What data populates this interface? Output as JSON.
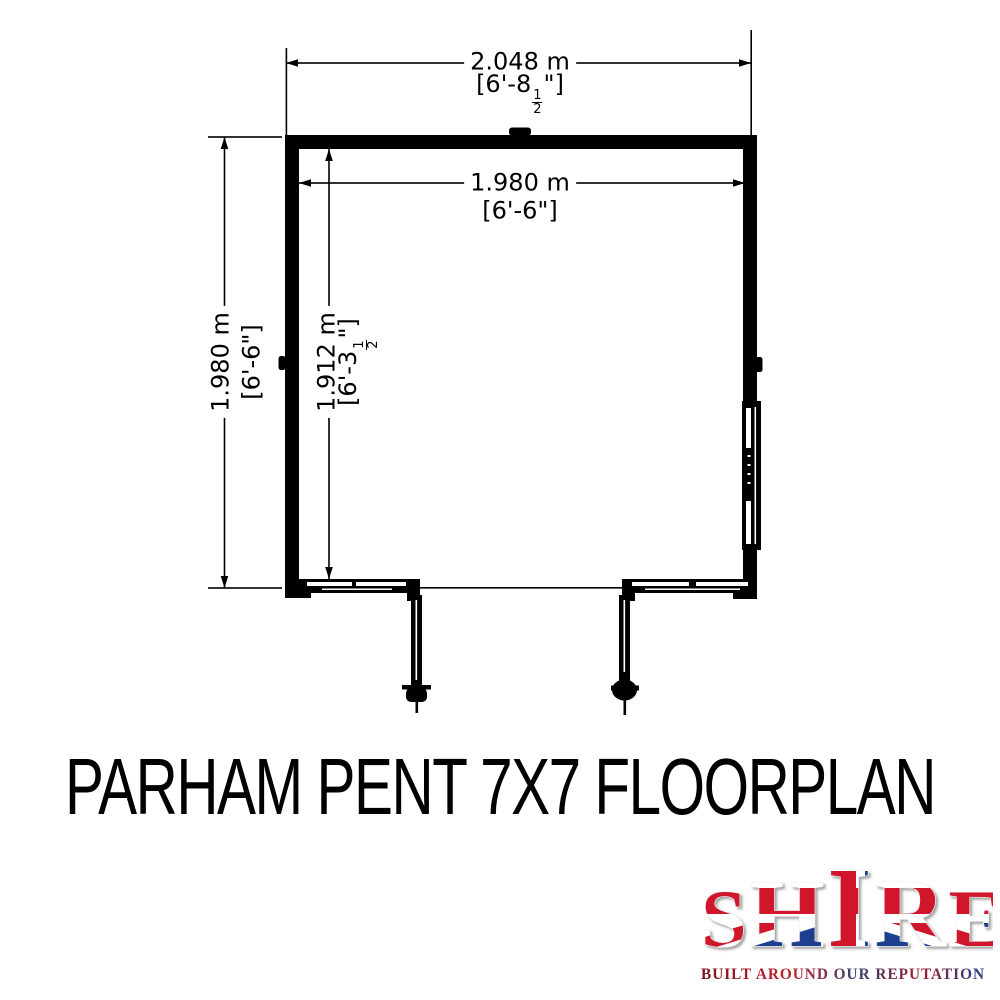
{
  "title": "PARHAM PENT 7X7 FLOORPLAN",
  "floorplan": {
    "dims": {
      "outer_width": {
        "metric": "2.048 m",
        "imperial_pre": "[6'-8",
        "frac_num": "1",
        "frac_den": "2",
        "imperial_post": "\"]"
      },
      "inner_width": {
        "metric": "1.980 m",
        "imperial": "[6'-6\"]"
      },
      "outer_depth": {
        "metric": "1.980 m",
        "imperial": "[6'-6\"]"
      },
      "inner_depth": {
        "metric": "1.912 m",
        "imperial_pre": "[6'-3",
        "frac_num": "1",
        "frac_den": "2",
        "imperial_post": "\"]"
      }
    },
    "line_color": "#000000",
    "background": "#ffffff"
  },
  "logo": {
    "brand_letters": [
      "S",
      "H",
      "I",
      "R",
      "E"
    ],
    "tagline": "BUILT AROUND OUR REPUTATION",
    "colors": {
      "red": "#cf142b",
      "blue": "#1e3f8f",
      "white": "#ffffff"
    }
  }
}
